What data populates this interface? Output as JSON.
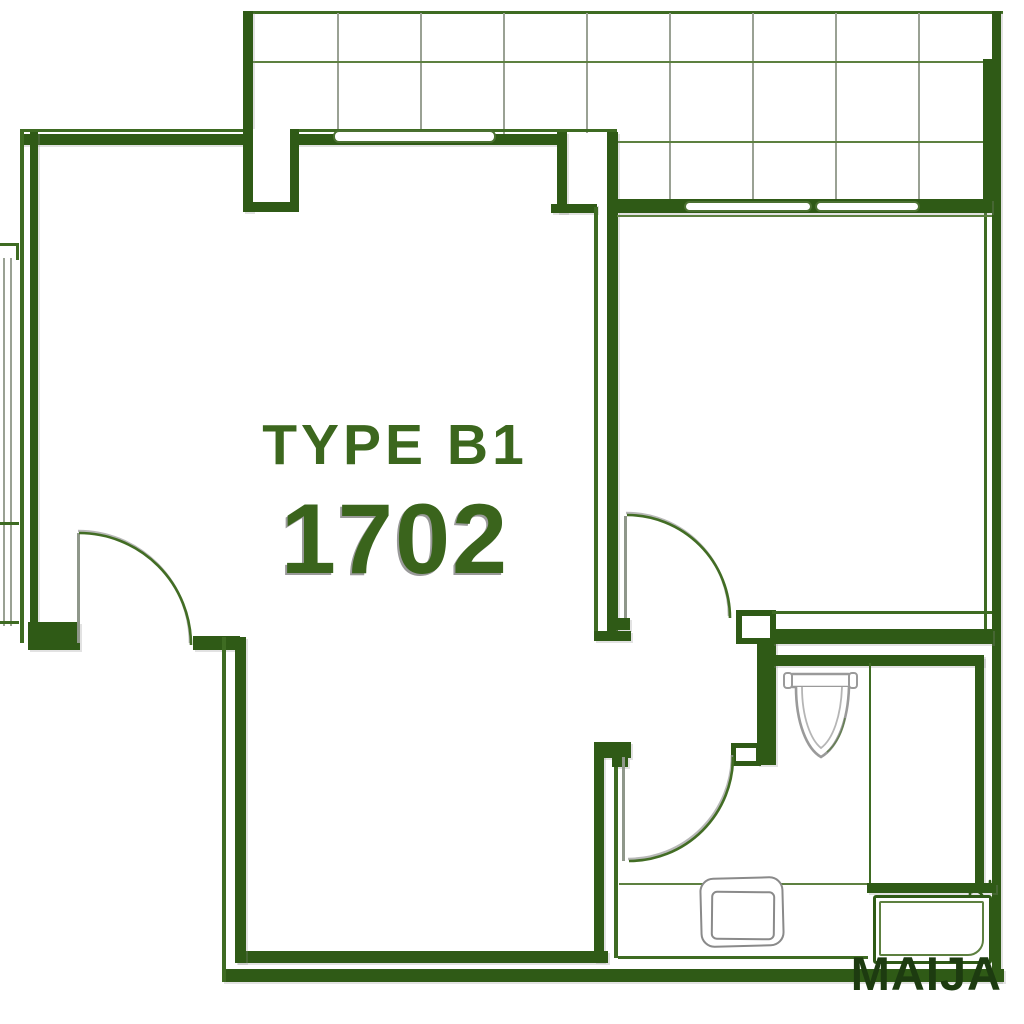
{
  "plan": {
    "type_label": "TYPE B1",
    "unit_number": "1702",
    "watermark": "MAIJA"
  },
  "fixtures": [
    "toilet",
    "vanity-sink",
    "bathtub",
    "faucet",
    "swing-door"
  ],
  "colors": {
    "bg": "#ffffff",
    "wall": "#2f5a16",
    "wall_line": "#3e6b22",
    "grid_line_v": "#9aa194",
    "grid_line_h": "#5d8040",
    "frame_green": "#4a7030",
    "arc_green": "#426d24",
    "leaf_gray": "#8f978a",
    "fixture_gray": "#9a9a9a",
    "fixture_light": "#b5b5b5",
    "label_green": "#3c671e",
    "number_green": "#3a641c",
    "number_shadow": "#9a9a9a",
    "watermark_green": "#1d3b10"
  }
}
